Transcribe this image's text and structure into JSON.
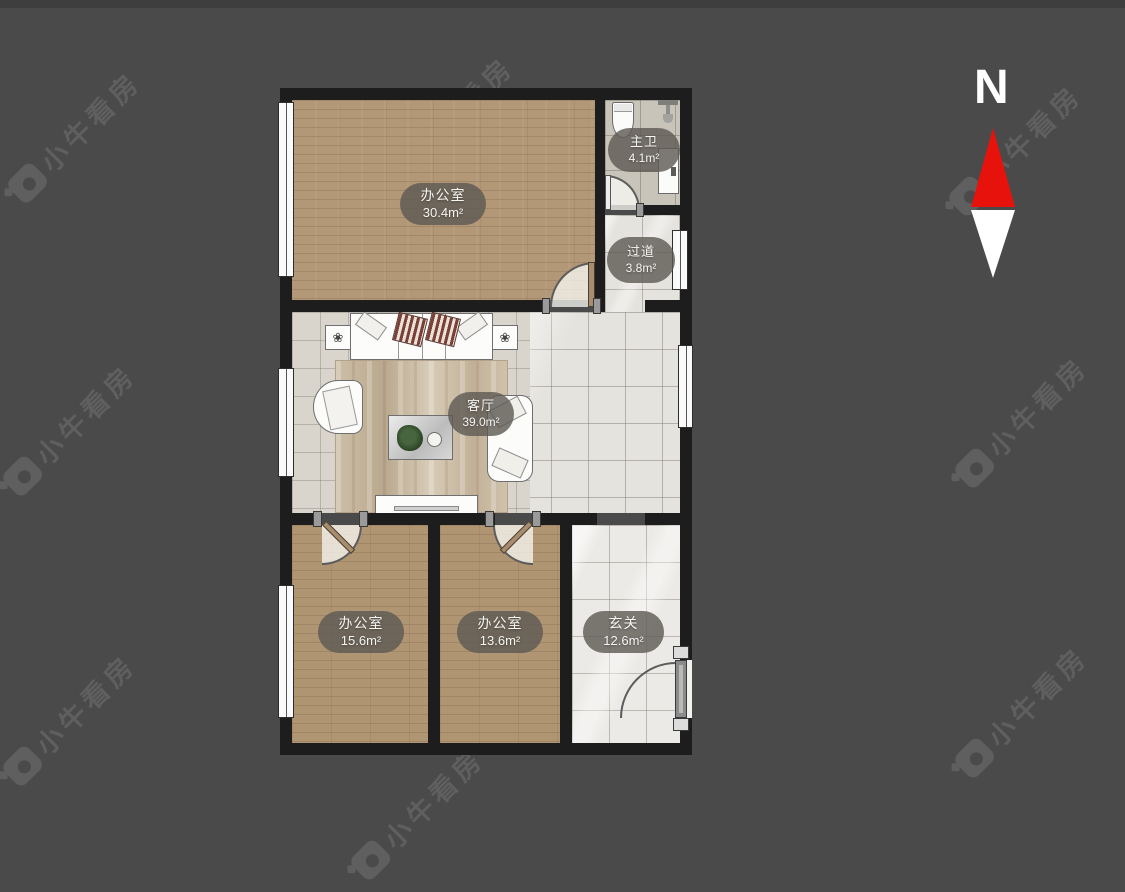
{
  "background": {
    "color": "#4a4a4a",
    "top_strip_color": "#3e3e3e"
  },
  "watermark": {
    "text": "小牛看房",
    "color": "#5f5f5f"
  },
  "compass": {
    "label": "N",
    "north_color": "#e8120c",
    "south_color": "#ffffff"
  },
  "floorplan": {
    "wall_color": "#1d1d1d",
    "wood_color": "#b39877",
    "marble_color": "#e5e3de",
    "rooms": [
      {
        "name": "办公室",
        "area": "30.4m²"
      },
      {
        "name": "主卫",
        "area": "4.1m²"
      },
      {
        "name": "过道",
        "area": "3.8m²"
      },
      {
        "name": "客厅",
        "area": "39.0m²"
      },
      {
        "name": "办公室",
        "area": "15.6m²"
      },
      {
        "name": "办公室",
        "area": "13.6m²"
      },
      {
        "name": "玄关",
        "area": "12.6m²"
      }
    ]
  }
}
